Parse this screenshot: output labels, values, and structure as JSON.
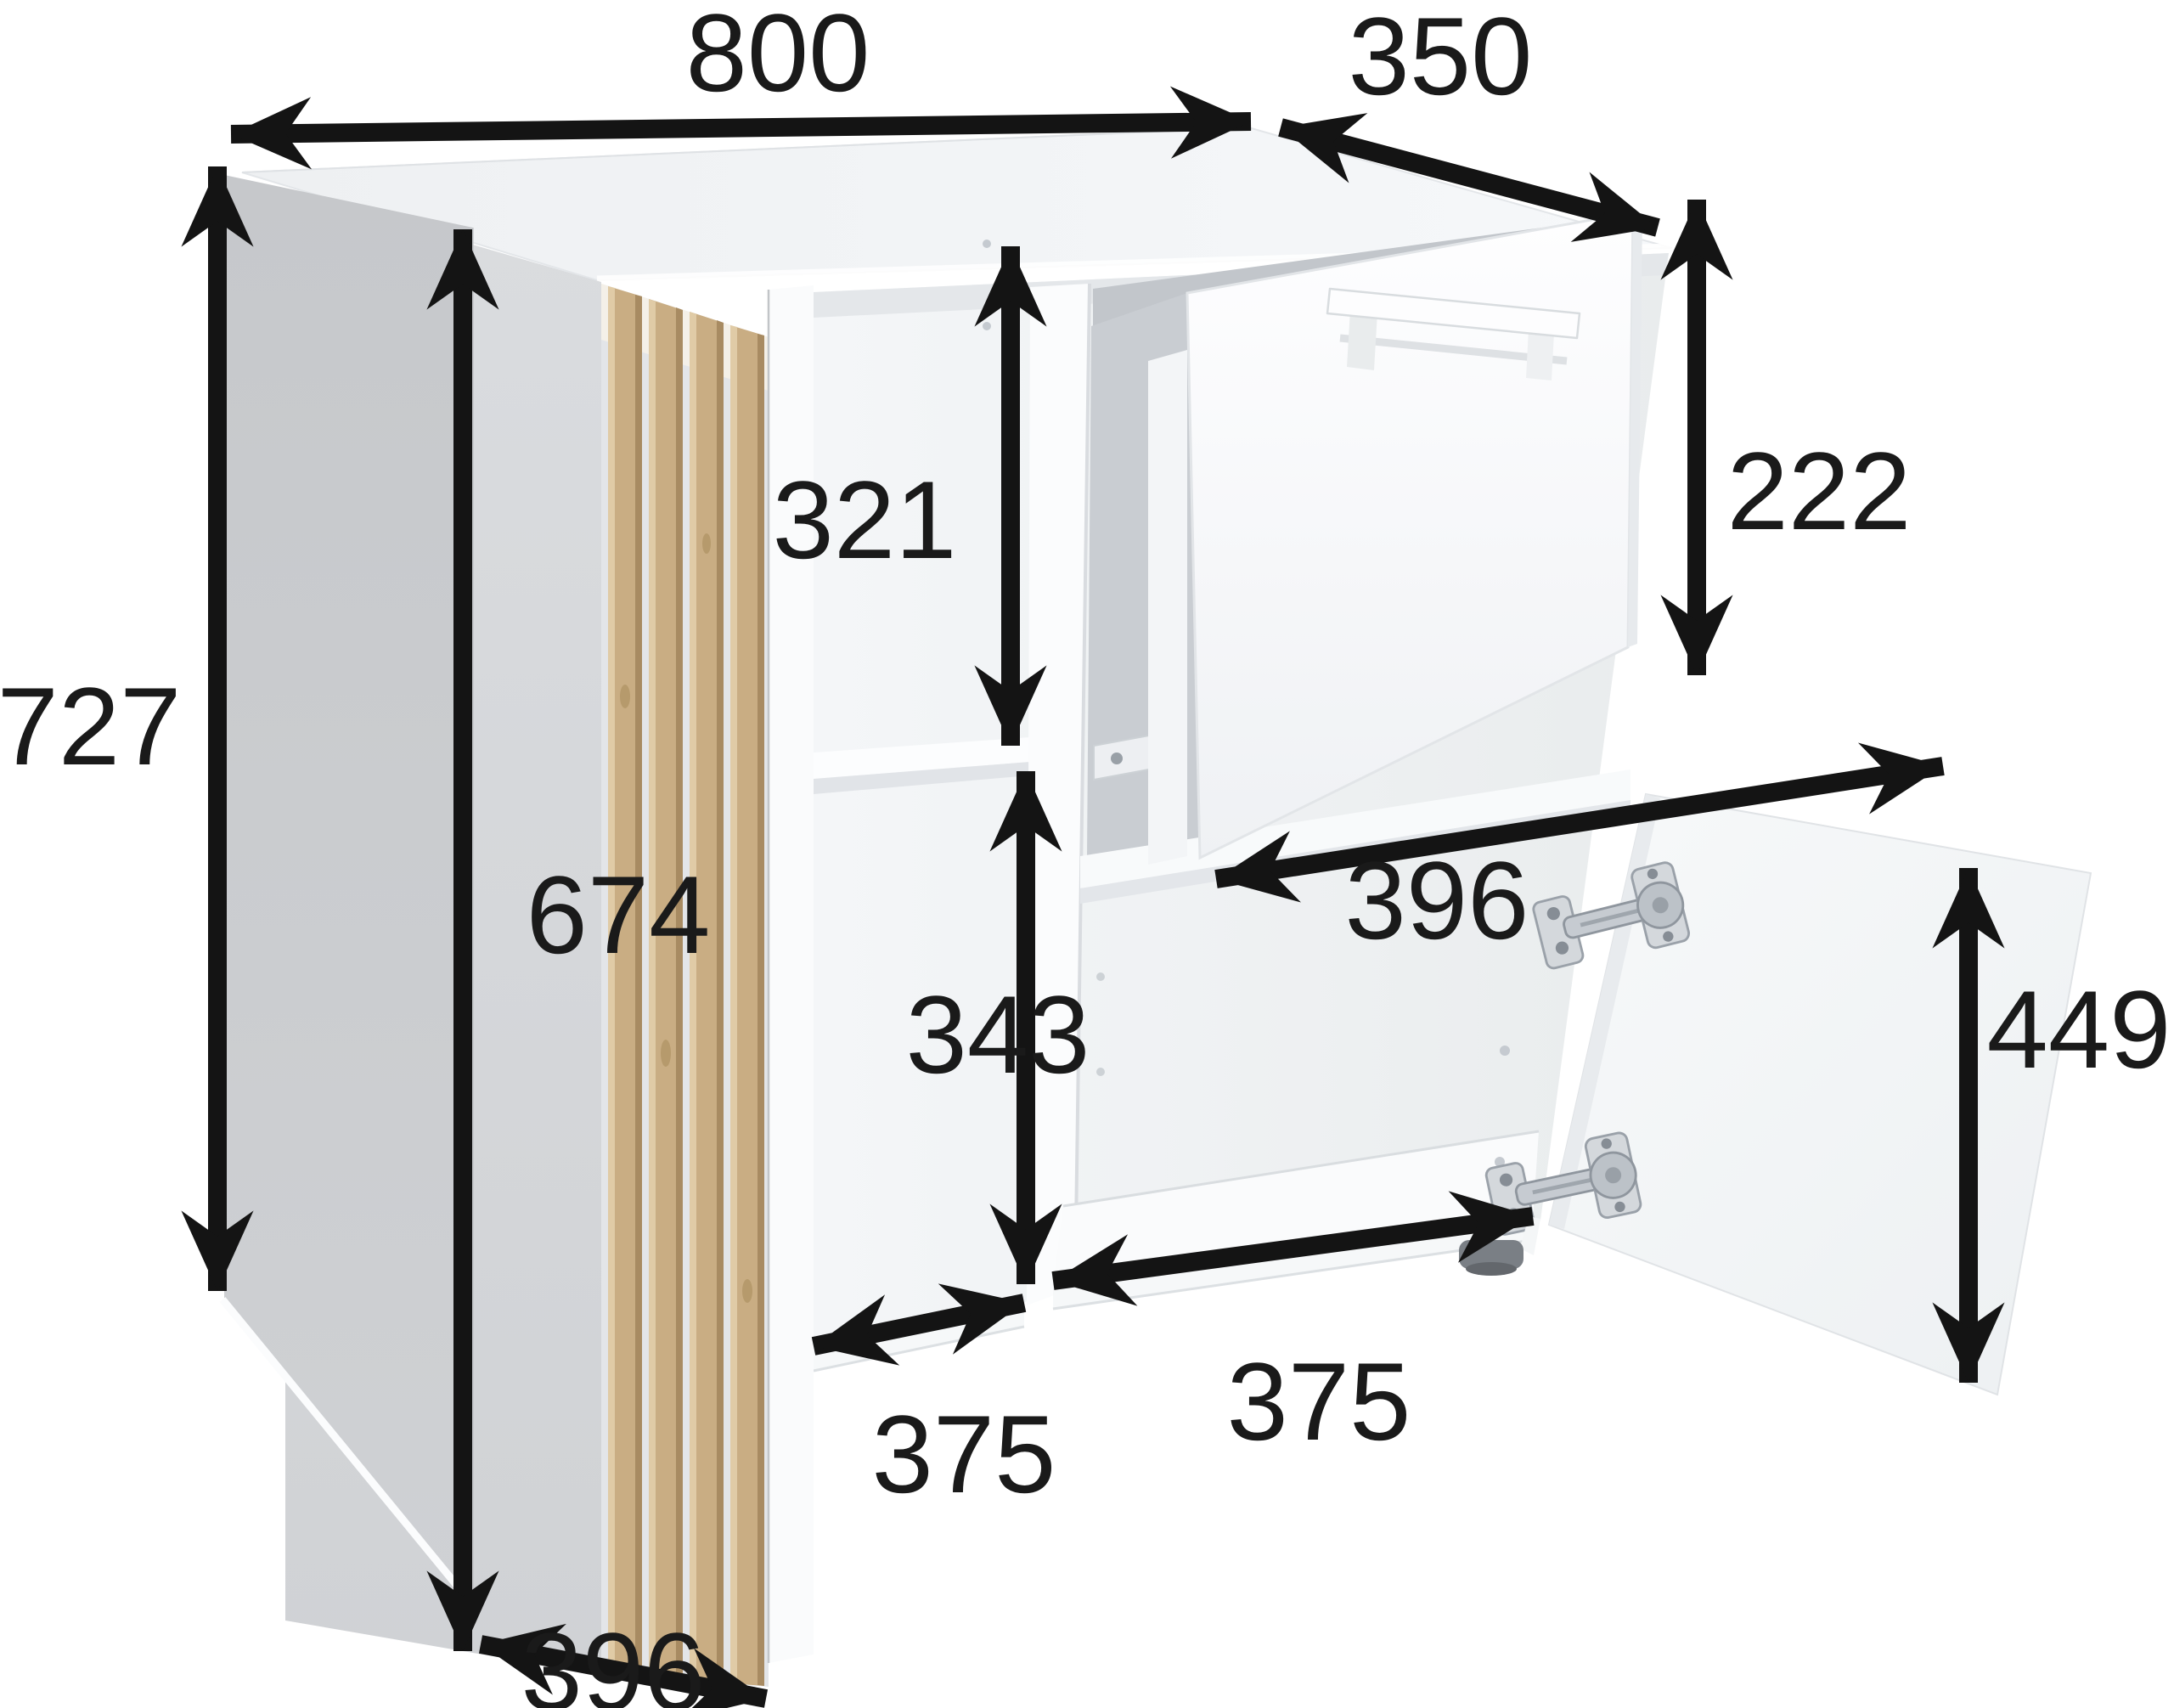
{
  "diagram": {
    "kind": "furniture-dimension-diagram",
    "subject": "sideboard cabinet shown open: slatted left door, pull-out drawer, right door",
    "colors": {
      "background": "#ffffff",
      "dimension_lines": "#141414",
      "labels": "#1a1a1a",
      "cabinet_white": "#f7f9fa",
      "door_panel_gray": "#d5d7da",
      "side_panel_gray": "#c9cbce",
      "wood_slat": "#c9ad83",
      "hinge_metal": "#c6cbd1"
    },
    "dimensions": {
      "total_width": "800",
      "total_depth": "350",
      "total_height": "727",
      "left_door_height": "674",
      "upper_compartment_height": "321",
      "lower_compartment_height": "343",
      "drawer_front_height": "222",
      "drawer_width": "396",
      "right_door_height": "449",
      "left_compartment_width": "375",
      "right_compartment_width": "375",
      "left_door_depth": "396"
    }
  }
}
